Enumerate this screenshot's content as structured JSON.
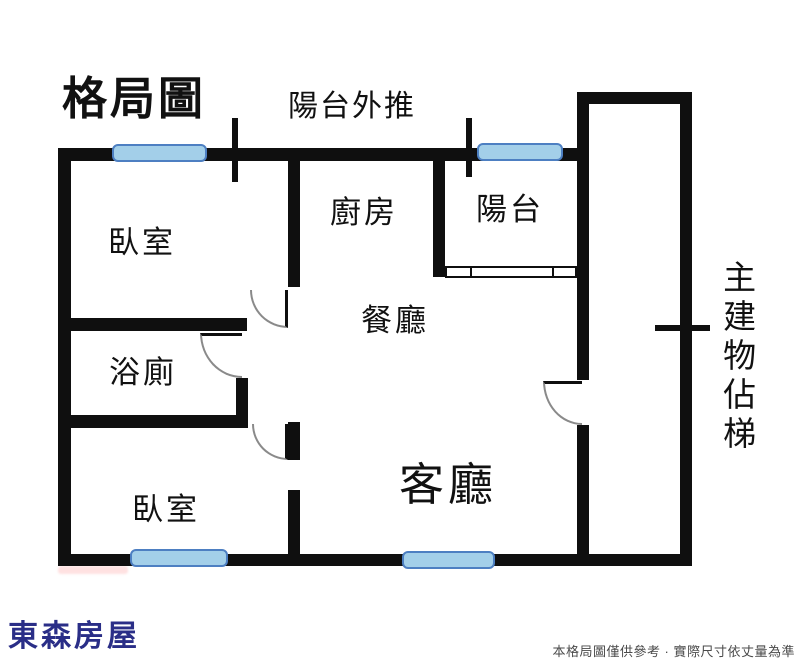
{
  "title": "格局圖",
  "annotations": {
    "balcony_pushed_out": "陽台外推",
    "stair_column": "主建物佔梯"
  },
  "rooms": {
    "bedroom_top": {
      "label": "臥室"
    },
    "bathroom": {
      "label": "浴廁"
    },
    "bedroom_bottom": {
      "label": "臥室"
    },
    "kitchen": {
      "label": "廚房"
    },
    "balcony": {
      "label": "陽台"
    },
    "dining": {
      "label": "餐廳"
    },
    "living": {
      "label": "客廳"
    }
  },
  "branding": {
    "agency_name": "東森房屋"
  },
  "disclaimer": "本格局圖僅供參考 · 實際尺寸依丈量為準",
  "colors": {
    "wall": "#0f0f0f",
    "window_fill": "#a3cfe9",
    "window_border": "#4d7fc2",
    "door_arc": "#8a8a8a",
    "brand": "#2a2e87",
    "disclaimer_color": "#4a4a4a"
  }
}
